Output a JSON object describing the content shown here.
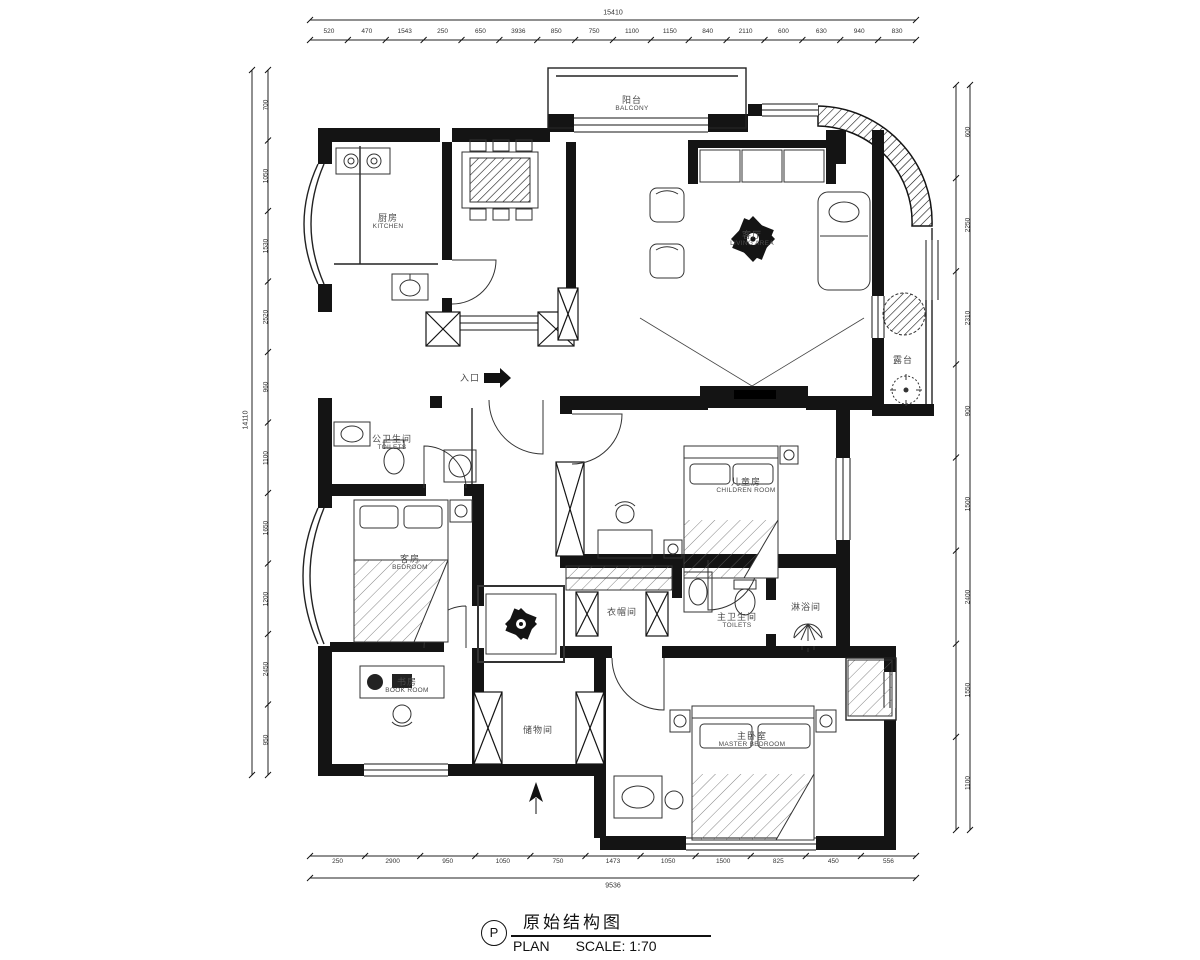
{
  "title": {
    "zh": "原始结构图",
    "p": "P",
    "plan": "PLAN",
    "scale": "SCALE: 1:70"
  },
  "rooms": {
    "balcony": {
      "zh": "阳台",
      "en": "BALCONY"
    },
    "kitchen": {
      "zh": "厨房",
      "en": "KITCHEN"
    },
    "living": {
      "zh": "客厅",
      "en": "LIVING AREA"
    },
    "terrace": {
      "zh": "露台",
      "en": ""
    },
    "entry": {
      "zh": "入口",
      "en": ""
    },
    "toilet_public": {
      "zh": "公卫生间",
      "en": "TOILETS"
    },
    "guest_bedroom": {
      "zh": "客房",
      "en": "BEDROOM"
    },
    "book_room": {
      "zh": "书房",
      "en": "BOOK ROOM"
    },
    "cloakroom": {
      "zh": "衣帽间",
      "en": ""
    },
    "master_toilet": {
      "zh": "主卫生间",
      "en": "TOILETS"
    },
    "shower": {
      "zh": "淋浴间",
      "en": ""
    },
    "storage": {
      "zh": "储物间",
      "en": ""
    },
    "children_room": {
      "zh": "儿童房",
      "en": "CHILDREN ROOM"
    },
    "master_bedroom": {
      "zh": "主卧室",
      "en": "MASTER BEDROOM"
    }
  },
  "dimensions": {
    "top": {
      "total": "15410",
      "ticks": [
        "520",
        "470",
        "1543",
        "250",
        "650",
        "3936",
        "850",
        "750",
        "1100",
        "1150",
        "840",
        "2110",
        "600",
        "630",
        "940",
        "830"
      ]
    },
    "bottom": {
      "total": "9536",
      "ticks": [
        "250",
        "2900",
        "950",
        "1050",
        "750",
        "1473",
        "1050",
        "1500",
        "825",
        "450",
        "556"
      ]
    },
    "left": {
      "total": "14110",
      "ticks": [
        "700",
        "1050",
        "1530",
        "2520",
        "960",
        "1100",
        "1650",
        "1200",
        "2450",
        "950"
      ]
    },
    "right": {
      "ticks": [
        "600",
        "2250",
        "2310",
        "900",
        "1500",
        "2400",
        "1550",
        "1100"
      ]
    }
  },
  "colors": {
    "line": "#141414",
    "label": "#4a4a4a"
  }
}
